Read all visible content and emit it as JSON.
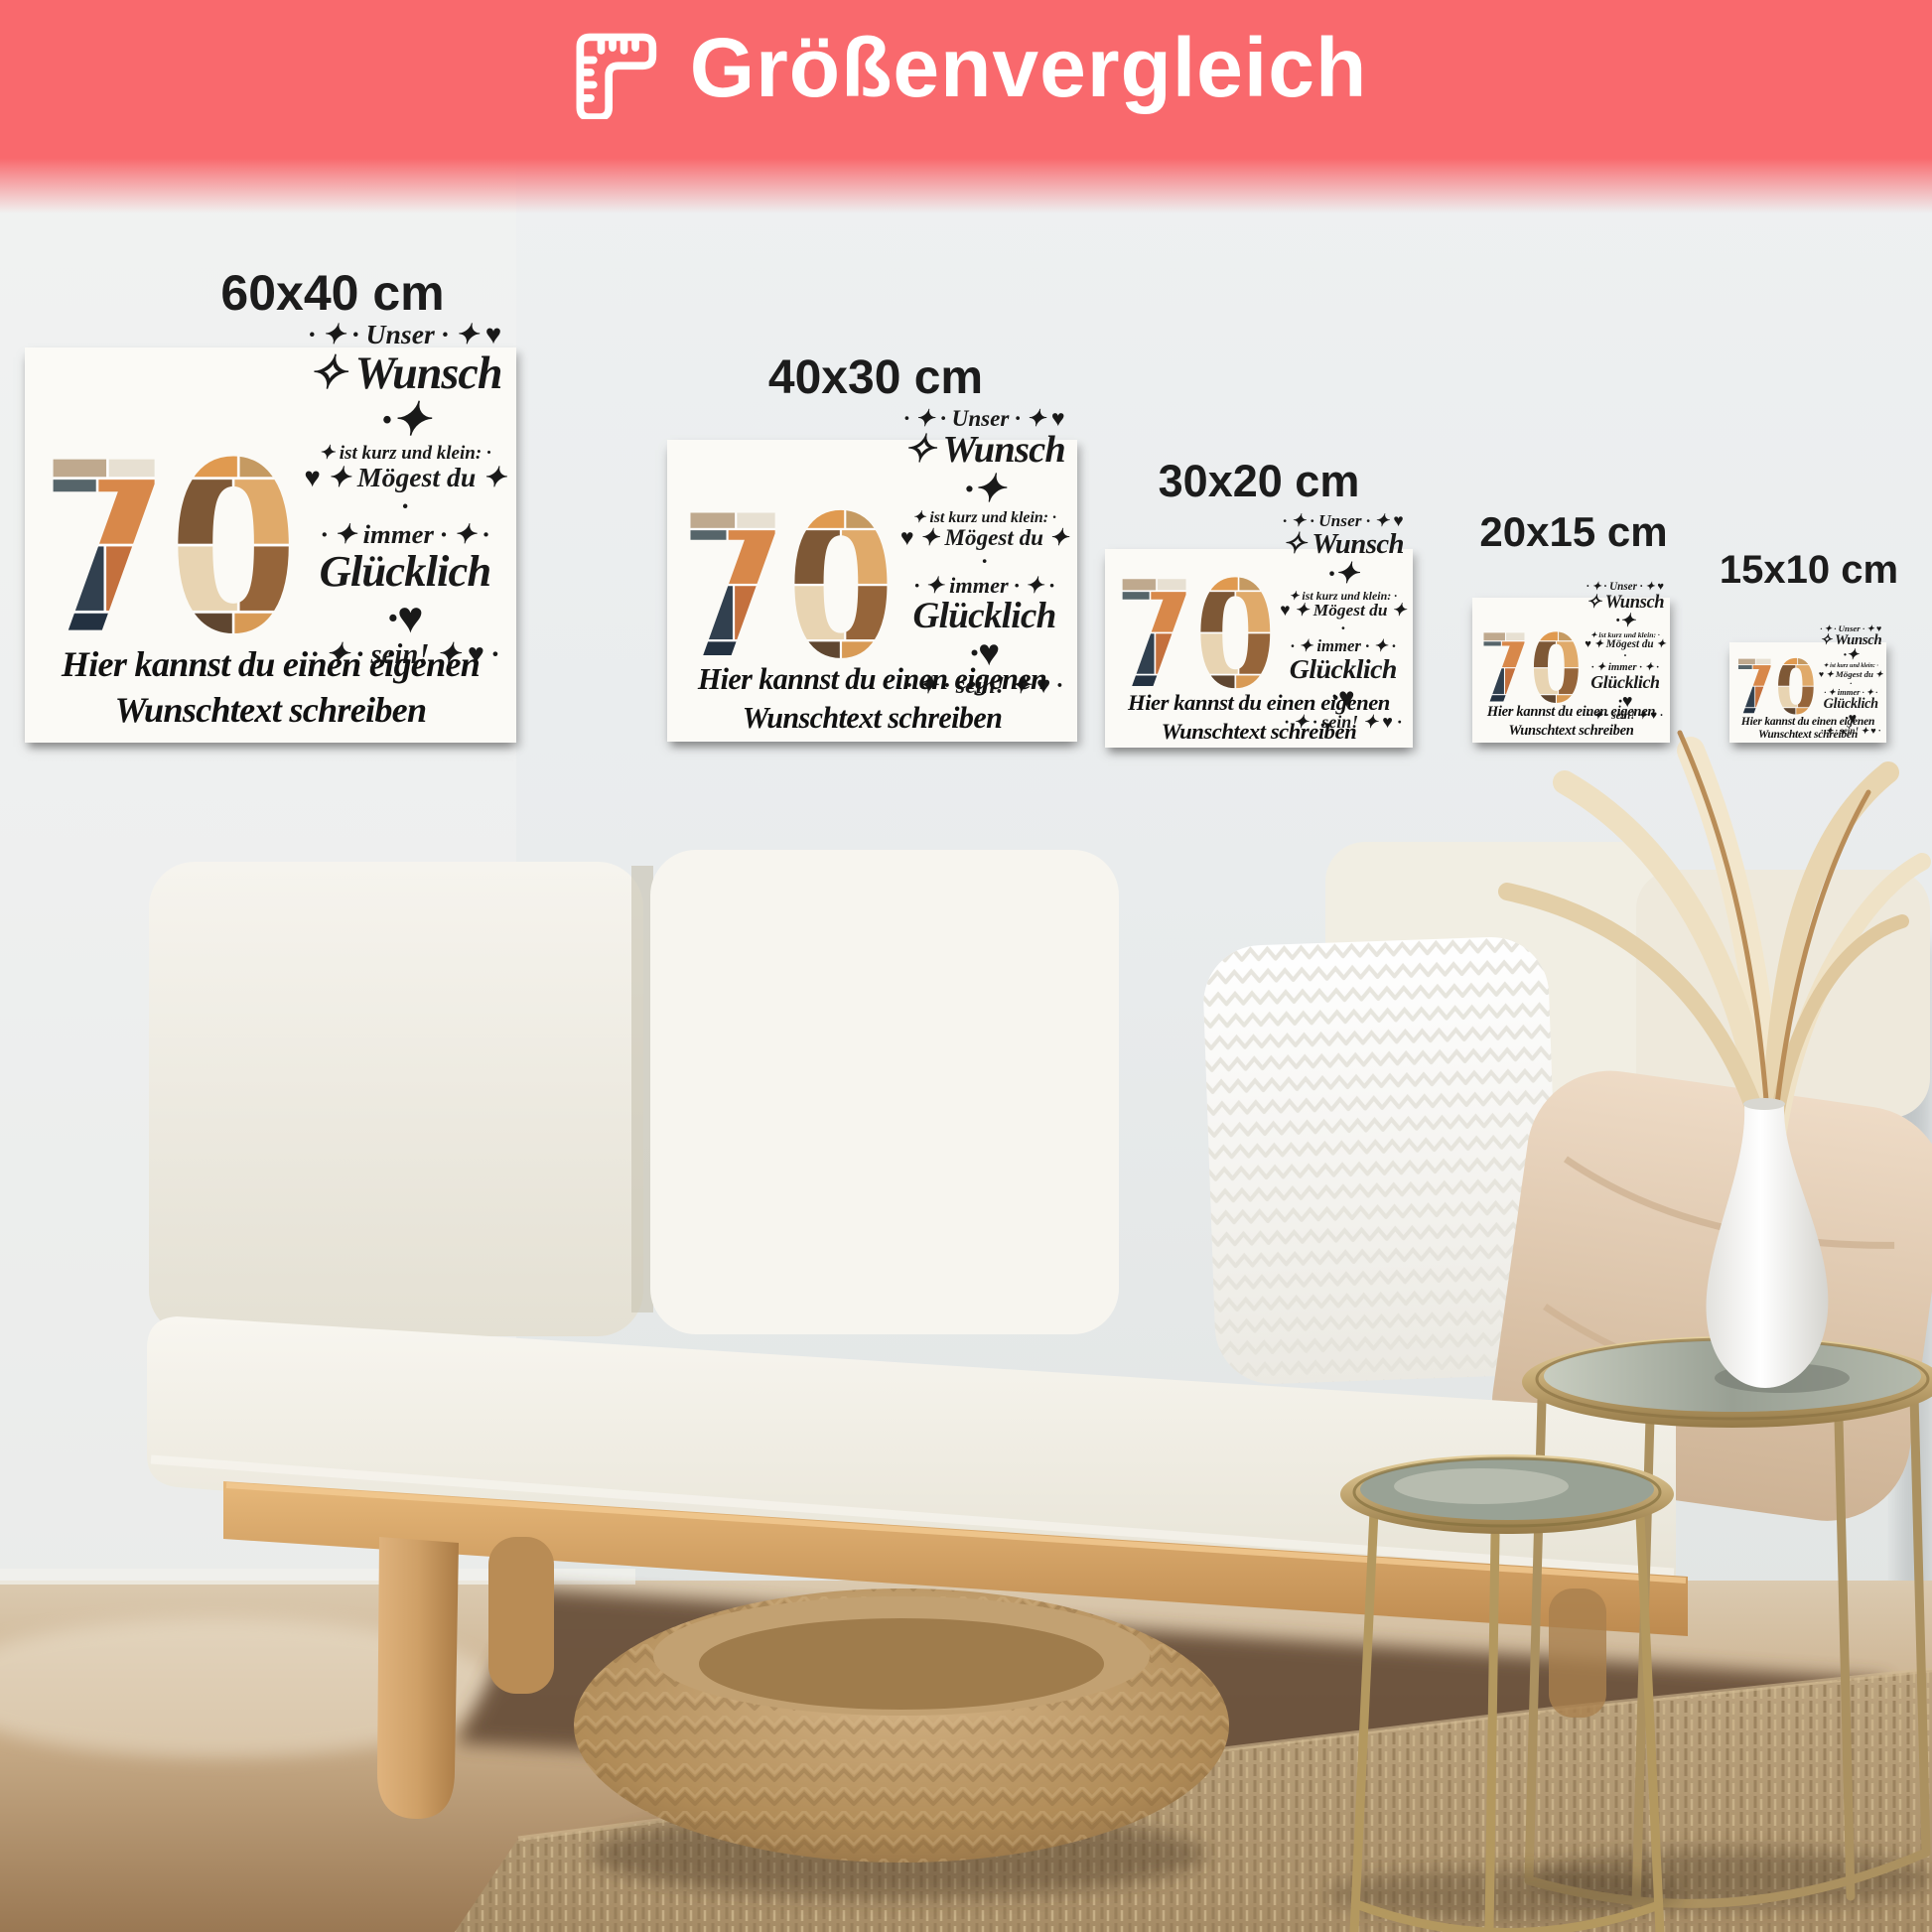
{
  "header": {
    "title": "Größenvergleich",
    "background_color": "#f9696d",
    "text_color": "#ffffff",
    "icon": "corner-ruler-icon"
  },
  "sizes": [
    "60x40 cm",
    "40x30 cm",
    "30x20 cm",
    "20x15 cm",
    "15x10 cm"
  ],
  "canvas_design": {
    "number": "70",
    "wish": {
      "line1": "· ✦ · Unser · ✦ ♥",
      "line2": "✧ Wunsch ·✦",
      "line3": "✦ ist kurz und klein: ·",
      "line4": "♥ ✦ Mögest du ✦ ·",
      "line5": "· ✦ immer · ✦ ·",
      "line6": "Glücklich ·♥",
      "line7": "· ✦ · sein! ✦ ♥ ·"
    },
    "custom_text_line1": "Hier kannst du einen eigenen",
    "custom_text_line2": "Wunschtext schreiben"
  },
  "palette": {
    "accent_coral": "#f9696d",
    "wall": "#e9eced",
    "floor_wood": "#cbb190",
    "bench_wood": "#d29a5f",
    "rug_jute": "#b39973",
    "pouf_weave": "#c2a070",
    "table_gold": "#b89a66",
    "photo_tones": [
      "#bfa98e",
      "#e7e0d2",
      "#e09a50",
      "#c59a62",
      "#56656a",
      "#d8884a",
      "#7e5836",
      "#e0aa6a",
      "#31404f",
      "#c4703d",
      "#e8d4b2",
      "#96653a",
      "#233141",
      "#b06f3e",
      "#5f4630",
      "#d89a55"
    ]
  }
}
